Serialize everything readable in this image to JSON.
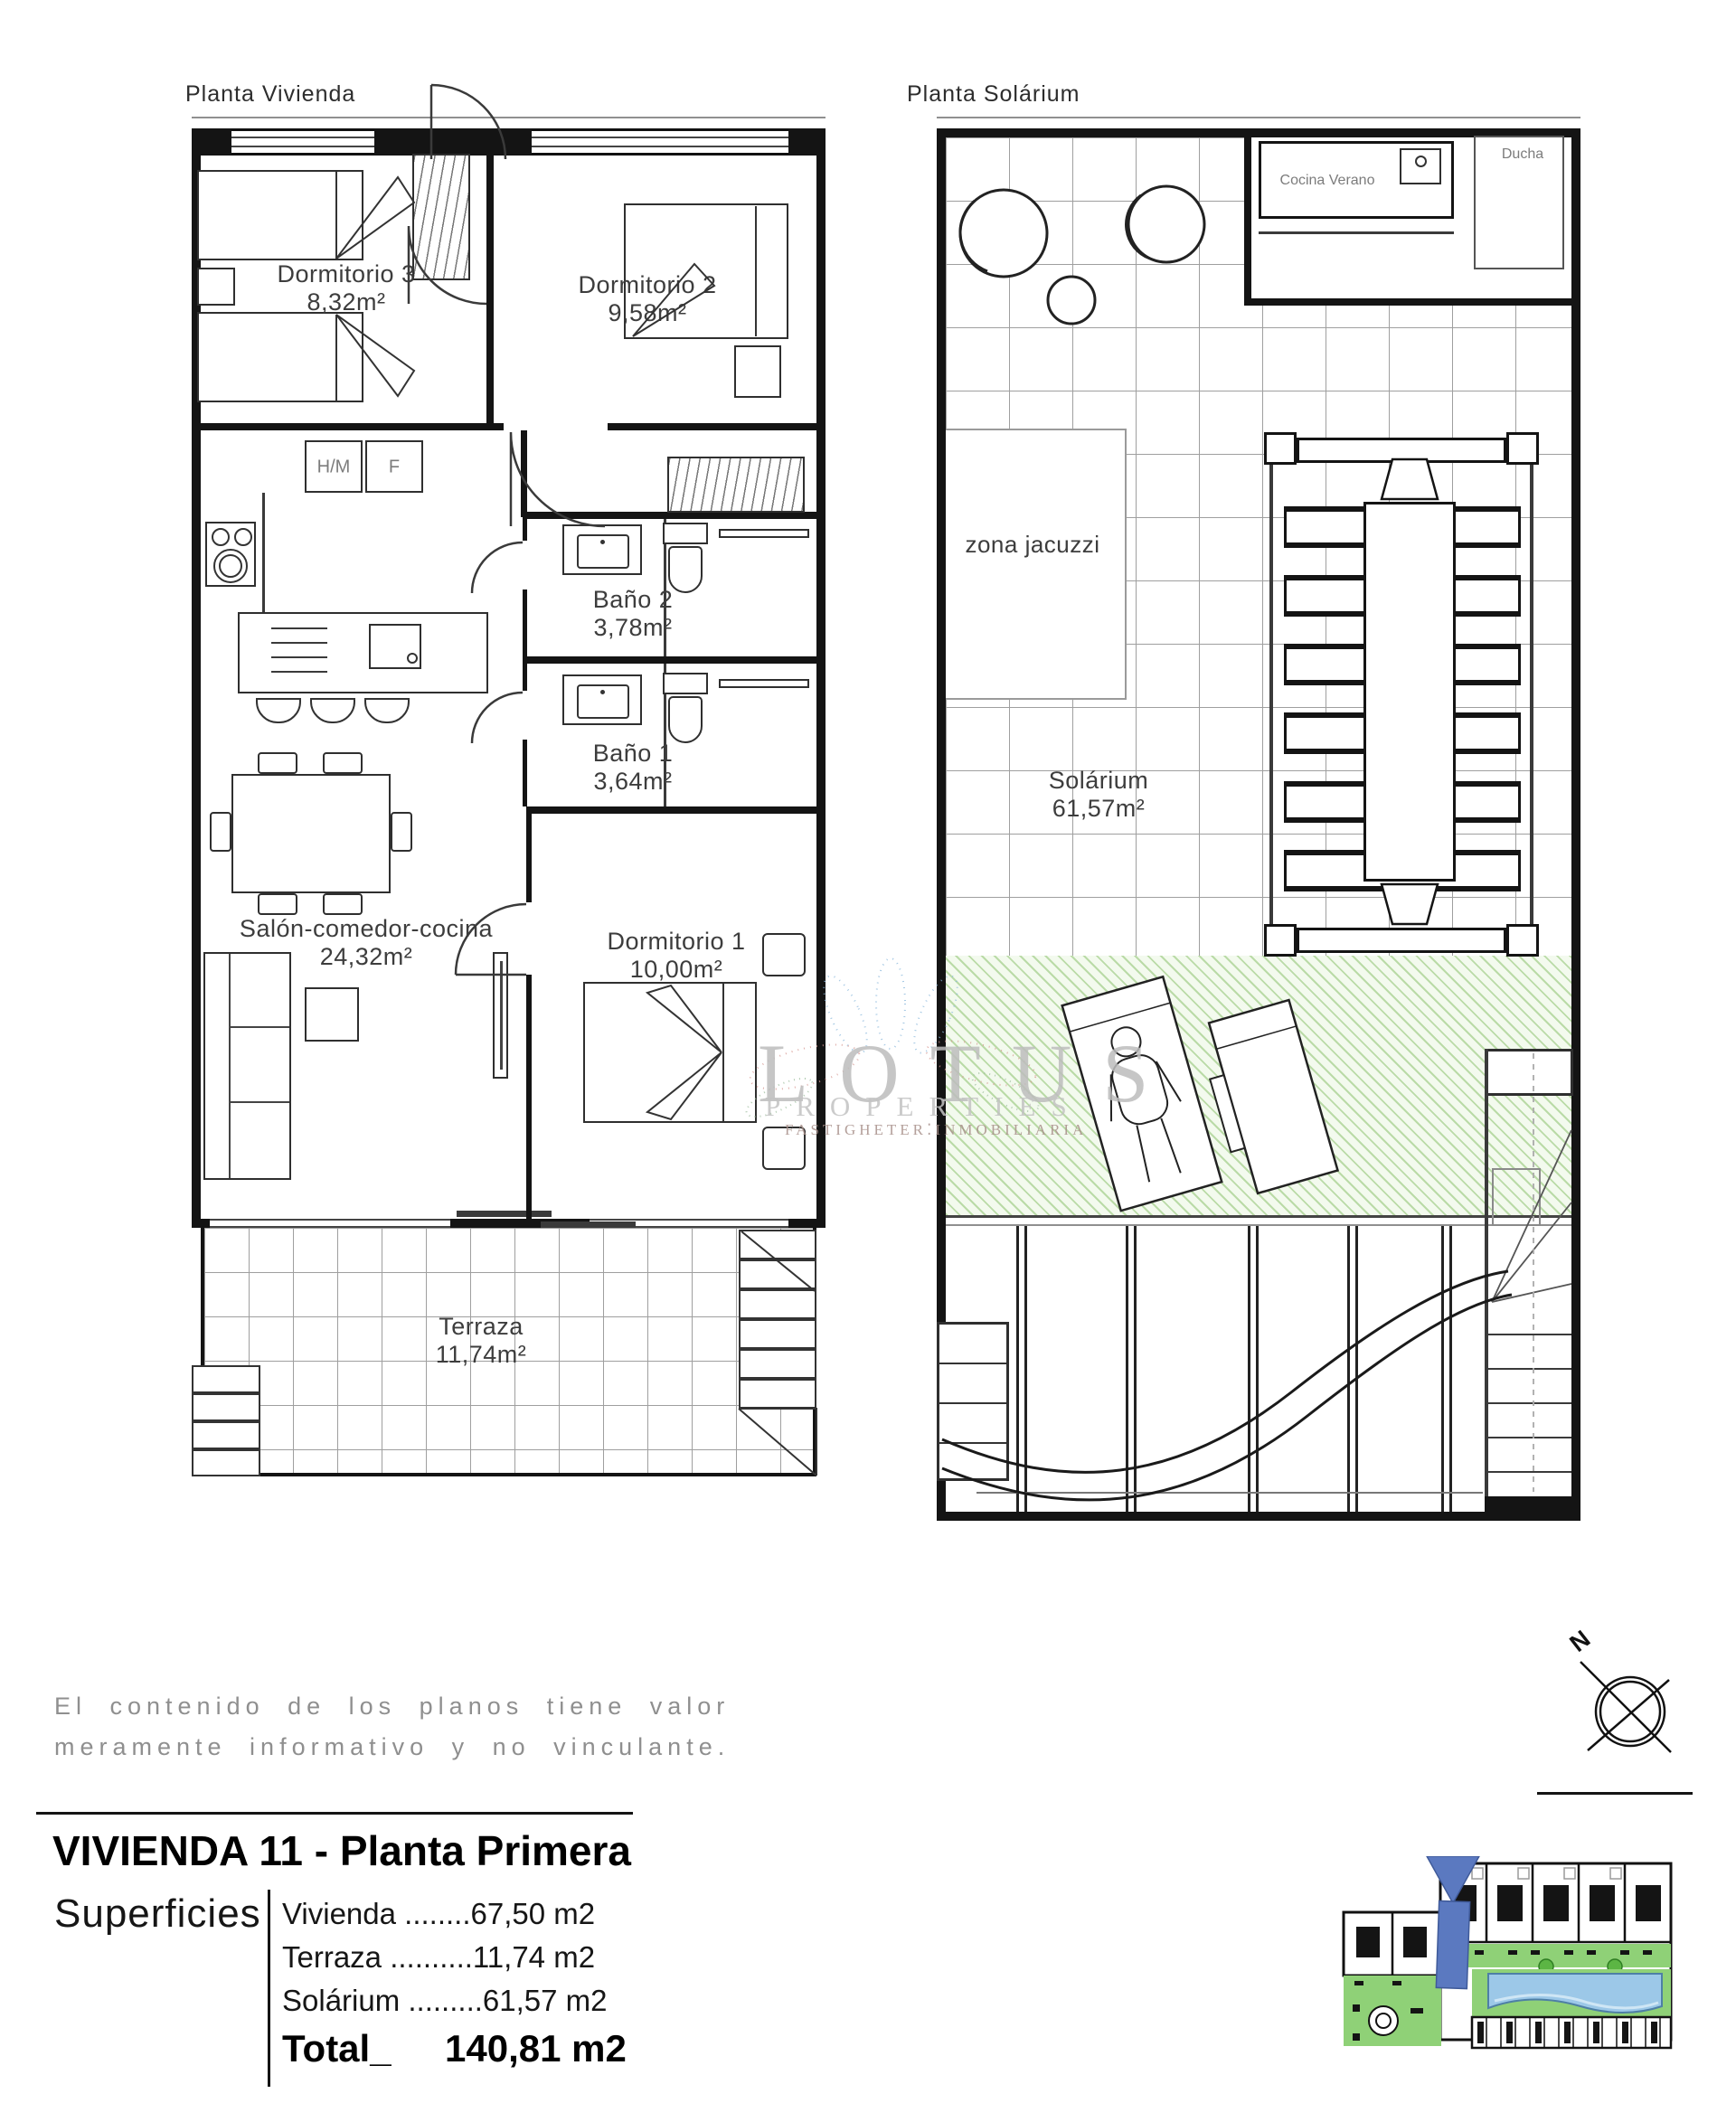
{
  "plans": {
    "vivienda": {
      "title": "Planta Vivienda",
      "rooms": {
        "dorm3": {
          "name": "Dormitorio 3",
          "area": "8,32m²"
        },
        "dorm2": {
          "name": "Dormitorio 2",
          "area": "9,58m²"
        },
        "bano2": {
          "name": "Baño 2",
          "area": "3,78m²"
        },
        "bano1": {
          "name": "Baño 1",
          "area": "3,64m²"
        },
        "salon": {
          "name": "Salón-comedor-cocina",
          "area": "24,32m²"
        },
        "dorm1": {
          "name": "Dormitorio 1",
          "area": "10,00m²"
        },
        "terraza": {
          "name": "Terraza",
          "area": "11,74m²"
        }
      },
      "appliances": {
        "hm": "H/M",
        "f": "F"
      }
    },
    "solarium": {
      "title": "Planta Solárium",
      "rooms": {
        "cocina": {
          "name": "Cocina Verano"
        },
        "ducha": {
          "name": "Ducha"
        },
        "jacuzzi": {
          "name": "zona jacuzzi"
        },
        "solarium": {
          "name": "Solárium",
          "area": "61,57m²"
        }
      }
    }
  },
  "watermark": {
    "brand": "LOTUS",
    "line2": "PROPERTIES",
    "line3": "FASTIGHETER⁚INMOBILIARIA"
  },
  "disclaimer": {
    "line1": "El contenido de los planos tiene valor",
    "line2": "meramente informativo y no vinculante."
  },
  "compass": {
    "north": "N"
  },
  "titleblock": {
    "title": "VIVIENDA 11 - Planta Primera",
    "surfaces_label": "Superficies",
    "rows": [
      {
        "label": "Vivienda",
        "dots": " ........",
        "value": "67,50 m2"
      },
      {
        "label": "Terraza",
        "dots": " ..........",
        "value": "11,74 m2"
      },
      {
        "label": "Solárium",
        "dots": " .........",
        "value": "61,57 m2"
      }
    ],
    "total_label": "Total_",
    "total_value": "140,81 m2"
  },
  "colors": {
    "accent_blue": "#5b79c0",
    "garden_green": "#8fd177",
    "pool_blue": "#9cc8e8",
    "hatch_green": "#a8cf97"
  }
}
